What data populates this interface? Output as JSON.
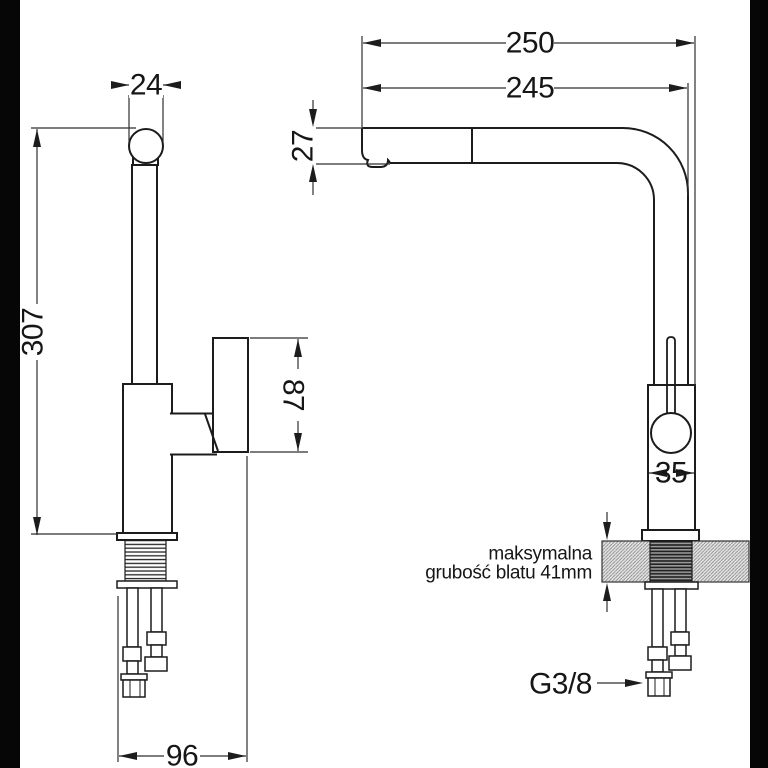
{
  "drawing_type": "faucet technical dimension drawing",
  "side_view": {
    "spout_tube_diameter": "24",
    "total_height": "307",
    "handle_height": "87",
    "base_depth": "96"
  },
  "front_view": {
    "overall_reach": "250",
    "spout_reach": "245",
    "spout_outlet_height": "27",
    "body_width": "35",
    "max_counter_note_line1": "maksymalna",
    "max_counter_note_line2": "grubość blatu 41mm",
    "connection_thread": "G3/8"
  },
  "colors": {
    "background": "#ffffff",
    "side_bars": "#060606",
    "object_line": "#1c1c1c",
    "dimension_line": "#2e2e2e",
    "countertop_fill": "#e4e4e4"
  }
}
